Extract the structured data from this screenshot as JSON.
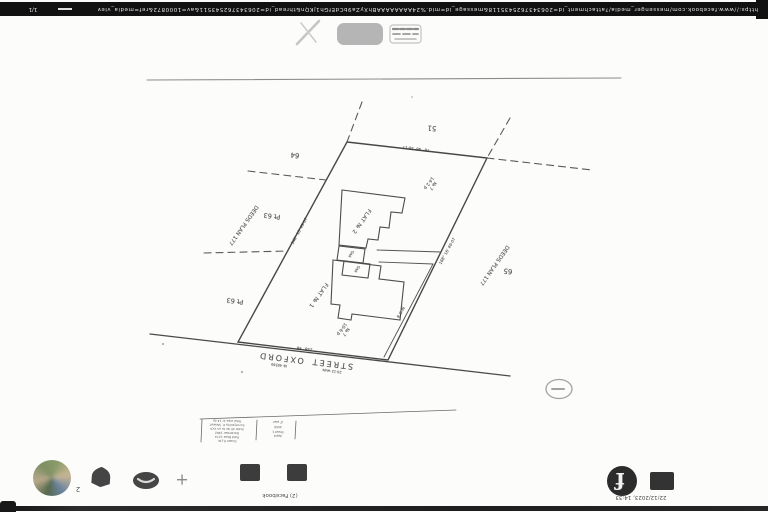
{
  "colors": {
    "scan_bar": "#111111",
    "plan_ink": "#4a4a4a",
    "chrome_icon": "#454545",
    "faint_icon": "#c0c0c0",
    "paper": "#fcfcfb"
  },
  "print_footer": {
    "page_number": "1/1",
    "url": "https://www.facebook.com/messenger_media/?attachment_id=2063437625435118&message_id=mid.%24AAAAAAAABhXyZa9bCdEfGh1jKQn&thread_id=206343762543511&av=1000872&ref=media_viewer"
  },
  "print_header": {
    "timestamp": "22/12/2023, 14:33",
    "tab_title": "(2) Facebook"
  },
  "browser_chrome": {
    "profile_badge": "2",
    "new_tab_label": "+",
    "facebook_logo_letter": "f"
  },
  "plan": {
    "street": {
      "word1": "OXFORD",
      "word2": "STREET",
      "sub1": "№ 40590",
      "sub2": "20·12 wide"
    },
    "buildings": {
      "flat2": "FLAT № 2",
      "flat1": "FLAT № 1",
      "gar1": "GAR",
      "gar2": "GAR"
    },
    "neighbour_lots": {
      "top_left": "64",
      "left_upper": "Pt 63",
      "left_lower": "Pt 63",
      "top_right": "51",
      "right": "65",
      "deeds_left": "DEEDS PLAN 177",
      "deeds_right": "DEEDS PLAN 177"
    },
    "area_labels": {
      "upper": "№ 7\n14·2 p",
      "lower": "№ 7\n10·6 p"
    },
    "bearings": {
      "top": "78° 46'   30·17",
      "left": "348° 16'   49·07",
      "right": "168° 16'   49·07",
      "street": "258° 46'",
      "row": "R.O.W."
    },
    "title_block": {
      "note": "tiny scanned rows, barely legible",
      "left_rows": [
        "Total area 1r 14·2p",
        "Surveyed by E. Stewart",
        "Scale 40 lks to an inch",
        "December 1962",
        "Field Book 1274",
        "Drawn E.J.M."
      ],
      "right_rows": [
        "LT plan",
        "4059",
        "Sheet 1",
        "Appd"
      ]
    },
    "stamp": "C"
  }
}
